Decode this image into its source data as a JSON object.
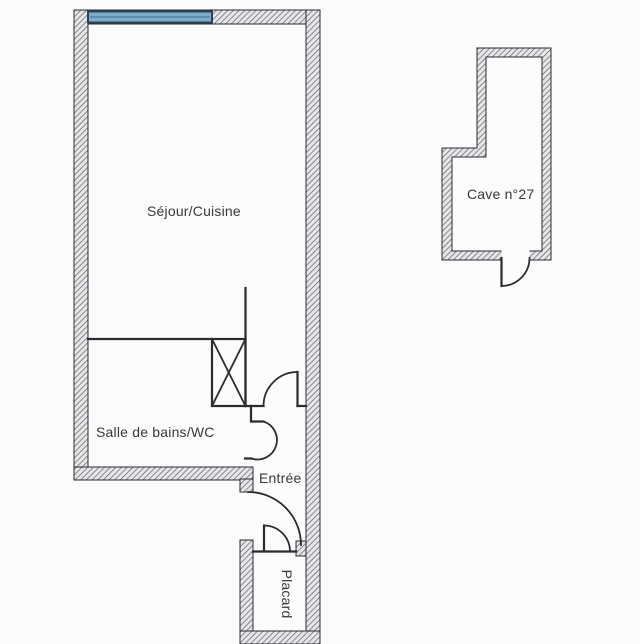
{
  "colors": {
    "background": "#fcfcfc",
    "wall_fill": "#e6e6e9",
    "wall_hatch_line": "#62626c",
    "line": "#2b2b30",
    "window_fill": "#7fadc9",
    "window_border": "#26445e",
    "window_center": "#4d7da0",
    "text": "#38383e"
  },
  "labels": {
    "sejour": "Séjour/Cuisine",
    "bathroom": "Salle de bains/WC",
    "entree": "Entrée",
    "placard": "Placard",
    "cave": "Cave n°27"
  }
}
